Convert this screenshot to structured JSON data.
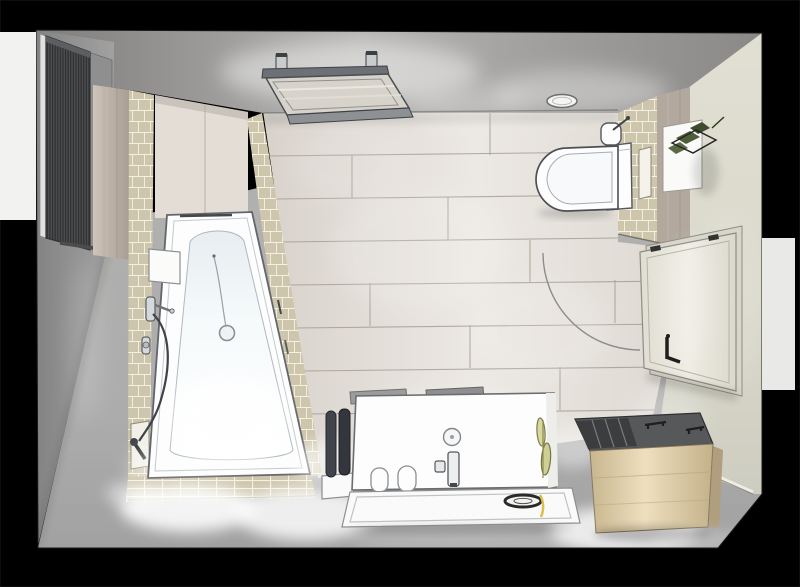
{
  "meta": {
    "scene": "3d-bathroom-planning-render",
    "view": "top-down perspective, front wall removed",
    "canvas": {
      "width": 800,
      "height": 587
    },
    "visible_text": "none"
  },
  "palette": {
    "backdrop": "#000000",
    "backdrop_panel_left": "#f2f2f0",
    "backdrop_panel_right": "#e9e9e7",
    "ceiling": "#8d8c8b",
    "wall_left": "#929292",
    "wall_right_cream": "#dcdacd",
    "floor_screed": "#aeaeae",
    "floor_plank_tile": "#e4dfd8",
    "plank_joint": "#a19b92",
    "mosaic_tile_beige": "#cdc5ac",
    "mosaic_grout": "#f6f2e4",
    "wood_trim": "#b3a89d",
    "head_panel_wood": "#e3ddd5",
    "radiator_anthracite": "#4a4c4e",
    "sanitary_white": "#fdfdfd",
    "outline_gray": "#565a5e",
    "chrome": "#c9ccce",
    "door_leaf_cream": "#e9e7dc",
    "handle_black": "#1e1e1e",
    "bench_top_gray": "#565859",
    "bench_wood_light": "#e2d2b2",
    "rug_white": "#fafafa",
    "towel_dark": "#33373d",
    "plant_green": "#4e5e39",
    "decor_yellow": "#dcbf49",
    "spotlight_glow": "#ffffff"
  },
  "objects": [
    {
      "id": "towel-radiator",
      "label": "vertical towel radiator",
      "wall": "left",
      "color_ref": "radiator_anthracite"
    },
    {
      "id": "skylight-window",
      "label": "roof window with opened sash",
      "surface": "sloped ceiling"
    },
    {
      "id": "ceiling-spotlight",
      "label": "oval ceiling light"
    },
    {
      "id": "corner-bathtub",
      "label": "asymmetric corner bathtub with mosaic surround"
    },
    {
      "id": "shower-mixer",
      "label": "wall-mounted mixer with hose"
    },
    {
      "id": "hand-shower",
      "label": "hand shower resting in wall niche"
    },
    {
      "id": "tub-shelf",
      "label": "white shelf box on tub rim"
    },
    {
      "id": "wall-hung-toilet",
      "label": "wall-hung toilet with cistern box"
    },
    {
      "id": "toilet-brush",
      "label": "toilet brush holder"
    },
    {
      "id": "partition-niche",
      "label": "recessed shelf in mosaic partition"
    },
    {
      "id": "toilet-partition",
      "label": "half-height mosaic partition wall"
    },
    {
      "id": "wall-planter",
      "label": "green plant holder on white wall panel"
    },
    {
      "id": "room-door",
      "label": "door opened flat against right wall, swing arc on floor"
    },
    {
      "id": "door-handle",
      "label": "black lever handle"
    },
    {
      "id": "washbasin-vanity",
      "label": "white washbasin counter"
    },
    {
      "id": "basin-faucet",
      "label": "single-lever basin faucet"
    },
    {
      "id": "soap-dispenser",
      "label": "soap pump"
    },
    {
      "id": "tumblers",
      "label": "two white tumblers"
    },
    {
      "id": "decor-grass",
      "label": "decorative grass leaves"
    },
    {
      "id": "rolled-towels",
      "label": "two dark rolled towels on white holder"
    },
    {
      "id": "bath-mat",
      "label": "white bath mat with dark bowl and yellow decor"
    },
    {
      "id": "storage-bench",
      "label": "light wood storage bench with open compartments"
    }
  ]
}
